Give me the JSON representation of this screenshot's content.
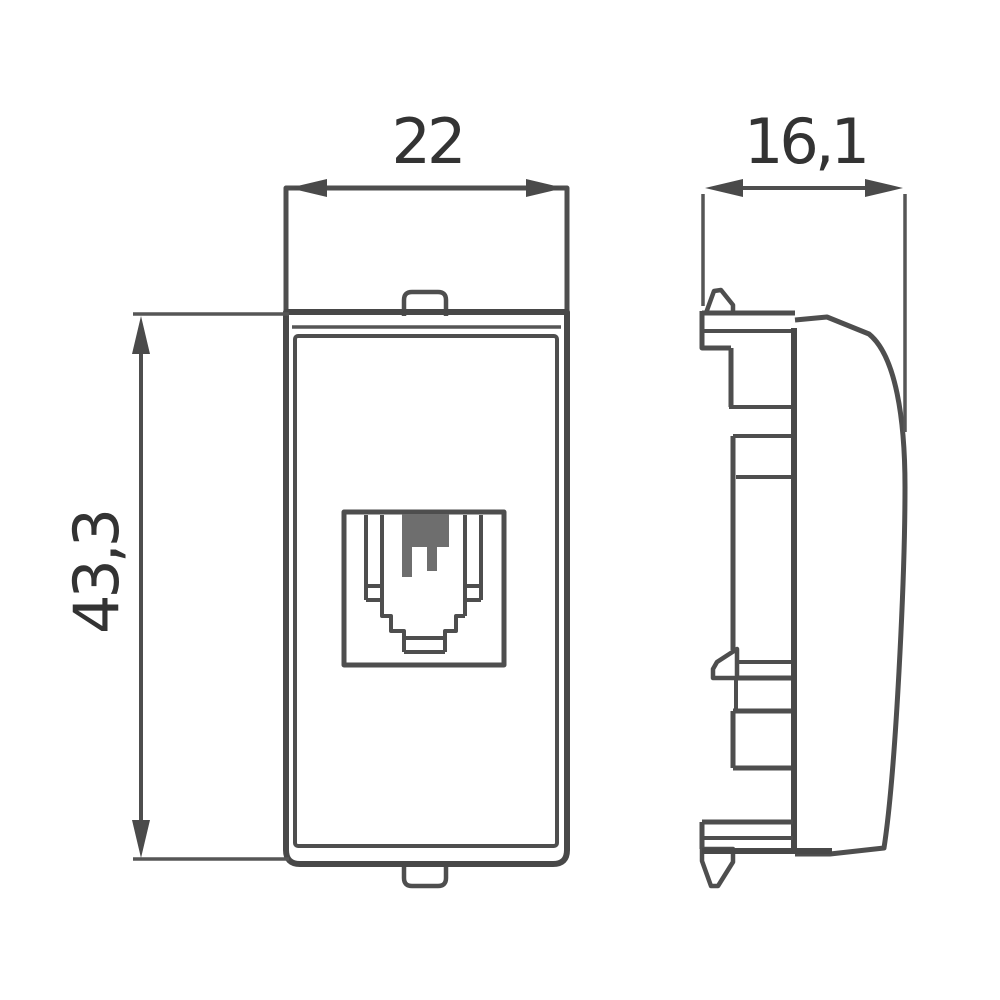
{
  "drawing": {
    "dimensions": {
      "width": "22",
      "depth": "16,1",
      "height": "43,3"
    },
    "colors": {
      "line": "#4e4e4e",
      "text": "#333333",
      "contact_fill": "#6e6e6e",
      "background": "#ffffff"
    }
  }
}
